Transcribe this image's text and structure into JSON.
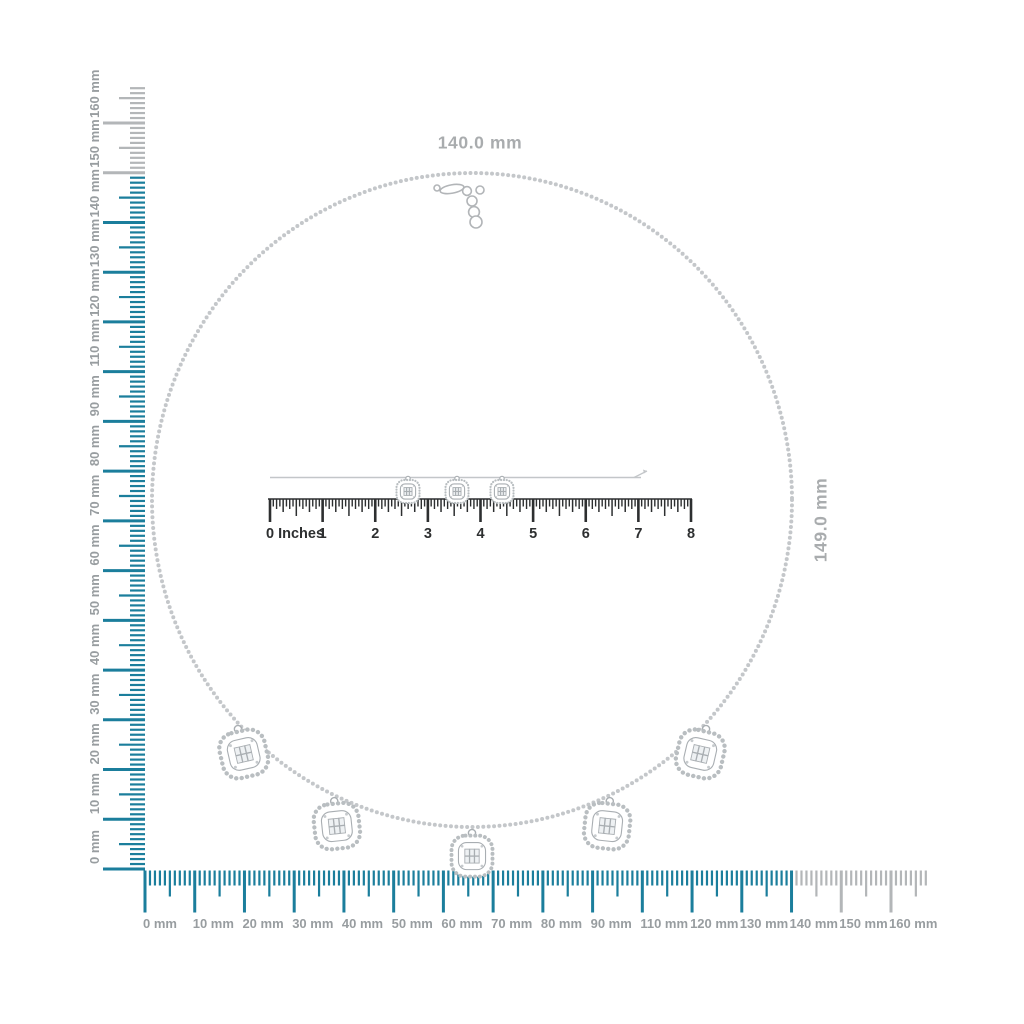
{
  "image_type": "jewelry-product-measurement-diagram",
  "dimensions": {
    "width_label": "140.0 mm",
    "height_label": "149.0 mm"
  },
  "rulers": {
    "vertical_mm": {
      "unit": "mm",
      "orientation": "vertical",
      "labels_bottom_to_top": [
        "0 mm",
        "10 mm",
        "20 mm",
        "30 mm",
        "40 mm",
        "50 mm",
        "60 mm",
        "70 mm",
        "80 mm",
        "90 mm",
        "110 mm",
        "120 mm",
        "130 mm",
        "140 mm",
        "150 mm",
        "160 mm"
      ]
    },
    "horizontal_mm": {
      "unit": "mm",
      "orientation": "horizontal",
      "labels_left_to_right": [
        "0 mm",
        "10 mm",
        "20 mm",
        "30 mm",
        "40 mm",
        "50 mm",
        "60 mm",
        "70 mm",
        "80 mm",
        "90 mm",
        "110 mm",
        "120 mm",
        "130 mm",
        "140 mm",
        "150 mm",
        "160 mm"
      ]
    },
    "inches": {
      "unit": "inches",
      "zero_label": "0 Inches",
      "labels": [
        "1",
        "2",
        "3",
        "4",
        "5",
        "6",
        "7",
        "8"
      ]
    }
  },
  "product": {
    "necklace_pendant_count": 5,
    "wire_charm_count": 3
  },
  "colors": {
    "accent_teal": "#1b7e9c",
    "ruler_gray": "#b3b6b8",
    "mm_label_gray": "#989da0",
    "dimension_label_gray": "#a9acae",
    "inch_ink": "#2d2f30",
    "chain_gray": "#c4c7ca",
    "pendant_stroke": "#a9aeb2",
    "halo_dots": "#b9bec1",
    "wire_gray": "#c3c6c9"
  }
}
